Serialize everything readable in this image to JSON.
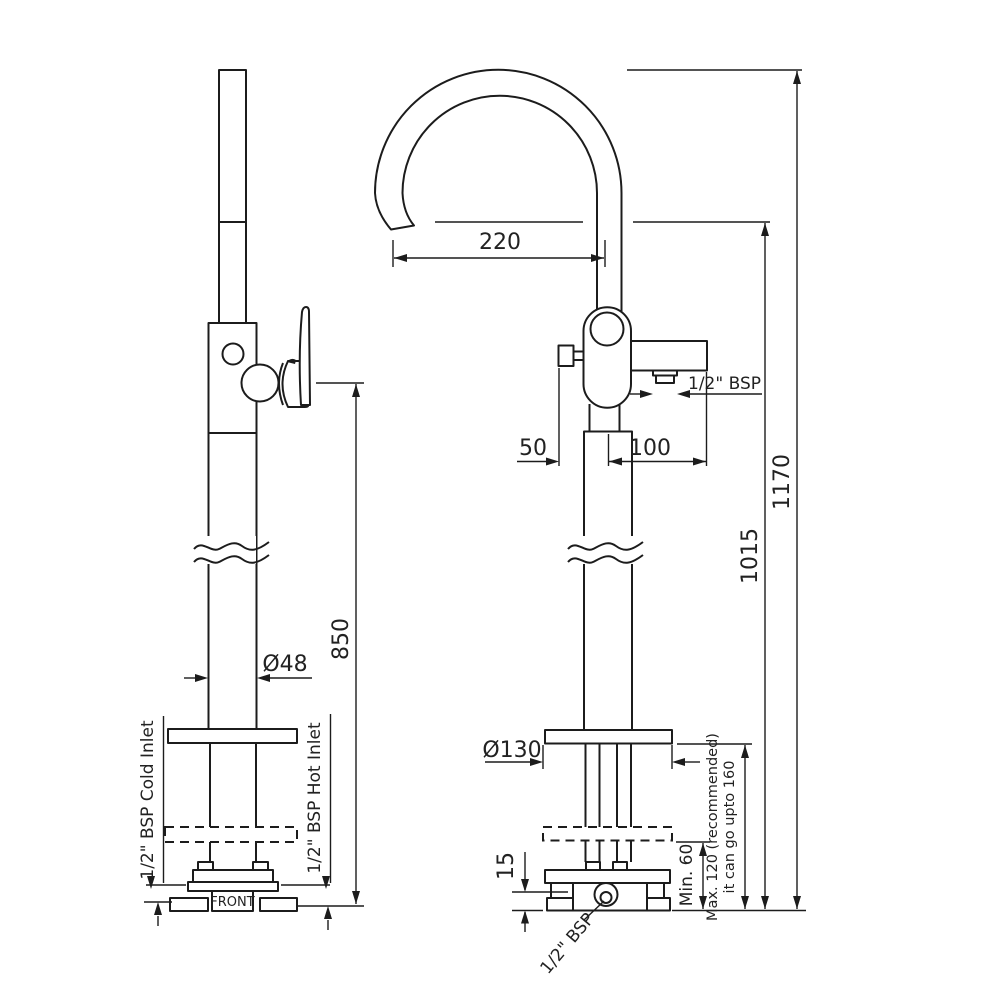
{
  "drawing": {
    "type": "technical dimension drawing",
    "subject": "floor-standing bath mixer with swivel spout, side view and front view",
    "dimensions": {
      "spout_reach": "220",
      "overall_height": "1170",
      "spout_outlet_height": "1015",
      "handle_height": "850",
      "riser_diameter": "Ø48",
      "flange_diameter": "Ø130",
      "knob_offset": "50",
      "spout_connection_offset": "100",
      "base_plate_height": "15",
      "min_clearance": "Min. 60",
      "max_clearance_line1": "Max. 120 (recommended)",
      "max_clearance_line2": "it can go upto 160"
    },
    "labels": {
      "front_marking": "FRONT",
      "cold_inlet": "1/2\" BSP Cold Inlet",
      "hot_inlet": "1/2\" BSP Hot Inlet",
      "spout_connection": "1/2\" BSP",
      "base_connection": "1/2\" BSP"
    },
    "colors": {
      "line": "#1c1c1c",
      "background": "#ffffff"
    }
  }
}
